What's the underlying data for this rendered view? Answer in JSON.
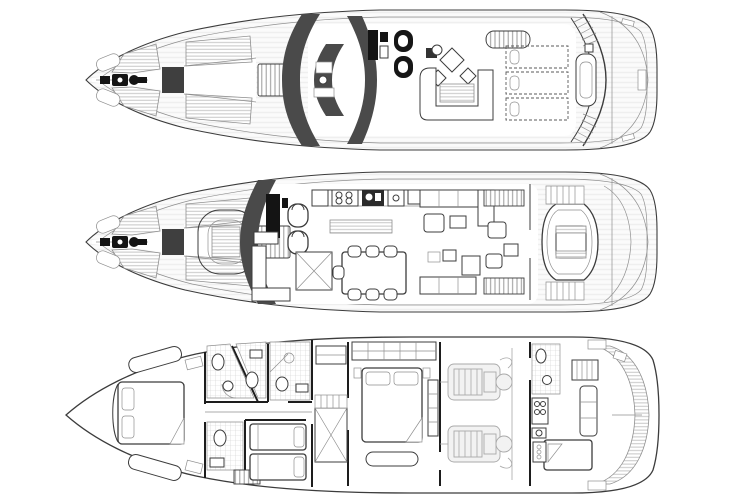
{
  "page": {
    "title": "Motor yacht general arrangement – three deck plans",
    "background": "#ffffff"
  },
  "colors": {
    "bg": "#ffffff",
    "line": "#3c3c3c",
    "lineL": "#8f8f8f",
    "glass": "#4a4a4a",
    "black": "#141414",
    "teak": "#c6c6c6",
    "tile": "#cfcfcf",
    "engine": "#a9a9a9",
    "floor": "#ffffff"
  },
  "decks": [
    {
      "id": "flybridge-deck",
      "label": "Flybridge / sun deck",
      "features": [
        "bow sunpads with teak panels",
        "anchor windlass",
        "foredeck hatch",
        "ventilation grate",
        "dark windscreen glazing bands",
        "helm console with twin helm seats",
        "cocktail table with two chairs",
        "wet bar grill",
        "U-shaped seating with table",
        "three sunpads with pillows",
        "radar arch with side steps",
        "aft deck"
      ]
    },
    {
      "id": "main-deck",
      "label": "Main deck",
      "features": [
        "bow sunpads with teak panels",
        "anchor windlass",
        "forward observation seating with table",
        "windscreen",
        "helm station with twin seats",
        "galley with stove, sink and fridge",
        "galley island",
        "staircase to lower deck",
        "dining table for six",
        "salon sofas and coffee tables",
        "sliding side doors",
        "aft cockpit C-shaped seating with table",
        "side boarding steps",
        "transom"
      ]
    },
    {
      "id": "lower-deck",
      "label": "Lower deck",
      "features": [
        "forward VIP cabin with island bed and settees",
        "two forward en-suite bathrooms",
        "day head",
        "twin guest cabin",
        "guest bathroom",
        "staircase",
        "full-beam master cabin with wardrobe and bed",
        "engine room with twin engines",
        "crew quarters with berth, galley and bathroom",
        "hydraulic swim platform / tender garage"
      ]
    }
  ]
}
